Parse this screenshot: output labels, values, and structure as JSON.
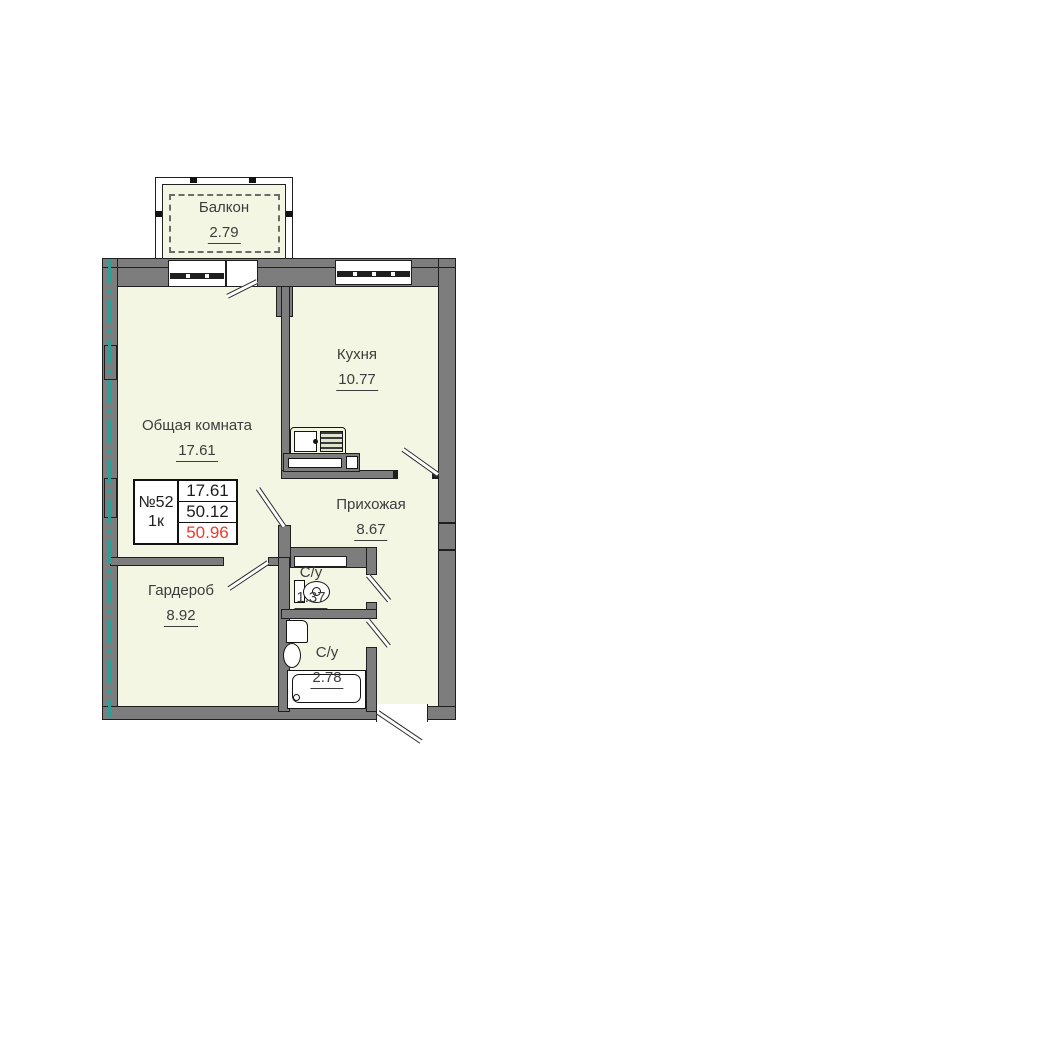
{
  "colors": {
    "room-fill": "#f3f6e2",
    "wall": "#7d7d7d",
    "axis": "#2f9e98",
    "red": "#ee3a2e",
    "text": "#3d3d3d"
  },
  "rooms": {
    "balcony": {
      "name": "Балкон",
      "area": "2.79"
    },
    "living_room": {
      "name": "Общая комната",
      "area": "17.61"
    },
    "kitchen": {
      "name": "Кухня",
      "area": "10.77"
    },
    "hallway": {
      "name": "Прихожая",
      "area": "8.67"
    },
    "wardrobe": {
      "name": "Гардероб",
      "area": "8.92"
    },
    "wc": {
      "name": "С/у",
      "area": "1.37"
    },
    "bathroom": {
      "name": "С/у",
      "area": "2.78"
    }
  },
  "info_card": {
    "apartment_number": "№52",
    "rooms_count": "1к",
    "living_area": "17.61",
    "area_without_balcony": "50.12",
    "total_area": "50.96"
  }
}
